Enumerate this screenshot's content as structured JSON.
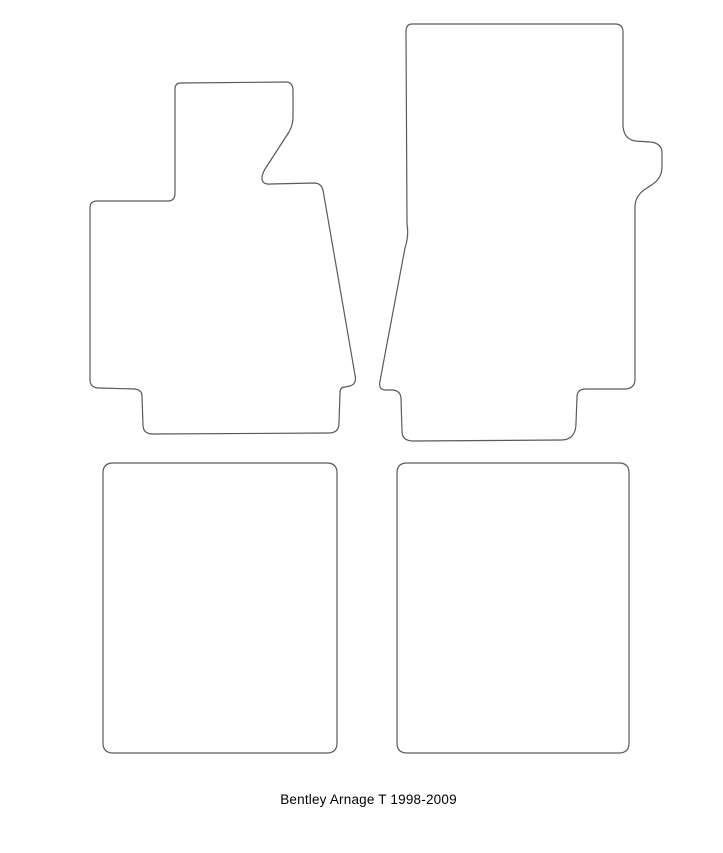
{
  "caption": "Bentley Arnage T 1998-2009",
  "colors": {
    "outline": "#5a5a5a",
    "background": "#ffffff",
    "text": "#000000"
  },
  "mats": [
    {
      "name": "driver-front-mat",
      "path": "M 181 83 L 286 82 Q 292 82 293 89 L 293 117 Q 293 125 289 132 L 267 166 Q 262 173 262 178 Q 262 185 271 184 L 314 183 Q 321 183 323 190 L 355 375 Q 357 384 350 386 L 345 387 Q 340 387 340 393 L 339 423 Q 339 433 329 433 L 153 434 Q 143 434 143 425 L 142 396 Q 142 390 135 389 L 99 388 Q 90 388 90 379 L 90 208 Q 90 201 97 201 L 168 201 Q 175 201 175 193 L 175 89 Q 175 83 181 83 Z"
    },
    {
      "name": "passenger-front-mat",
      "path": "M 412 24 L 615 24 Q 623 24 623 32 L 623 126 Q 624 139 635 141 L 650 142 Q 662 143 662 153 L 662 167 Q 662 179 650 186 L 647 188 Q 635 195 635 207 L 635 379 Q 635 388 626 389 L 586 389 Q 577 389 577 397 L 576 423 Q 576 440 561 440 L 413 441 Q 402 441 402 431 L 401 399 Q 401 391 393 390 L 386 390 Q 378 390 380 381 L 405 248 Q 409 236 407 224 L 406 32 Q 406 24 412 24 Z"
    },
    {
      "name": "rear-left-mat",
      "path": "M 113 463 L 327 463 Q 337 463 337 473 L 337 743 Q 337 753 327 753 L 113 753 Q 103 753 103 743 L 103 473 Q 103 463 113 463 Z"
    },
    {
      "name": "rear-right-mat",
      "path": "M 407 463 L 619 463 Q 629 463 629 473 L 629 743 Q 629 753 619 753 L 407 753 Q 397 753 397 743 L 397 473 Q 397 463 407 463 Z"
    }
  ]
}
